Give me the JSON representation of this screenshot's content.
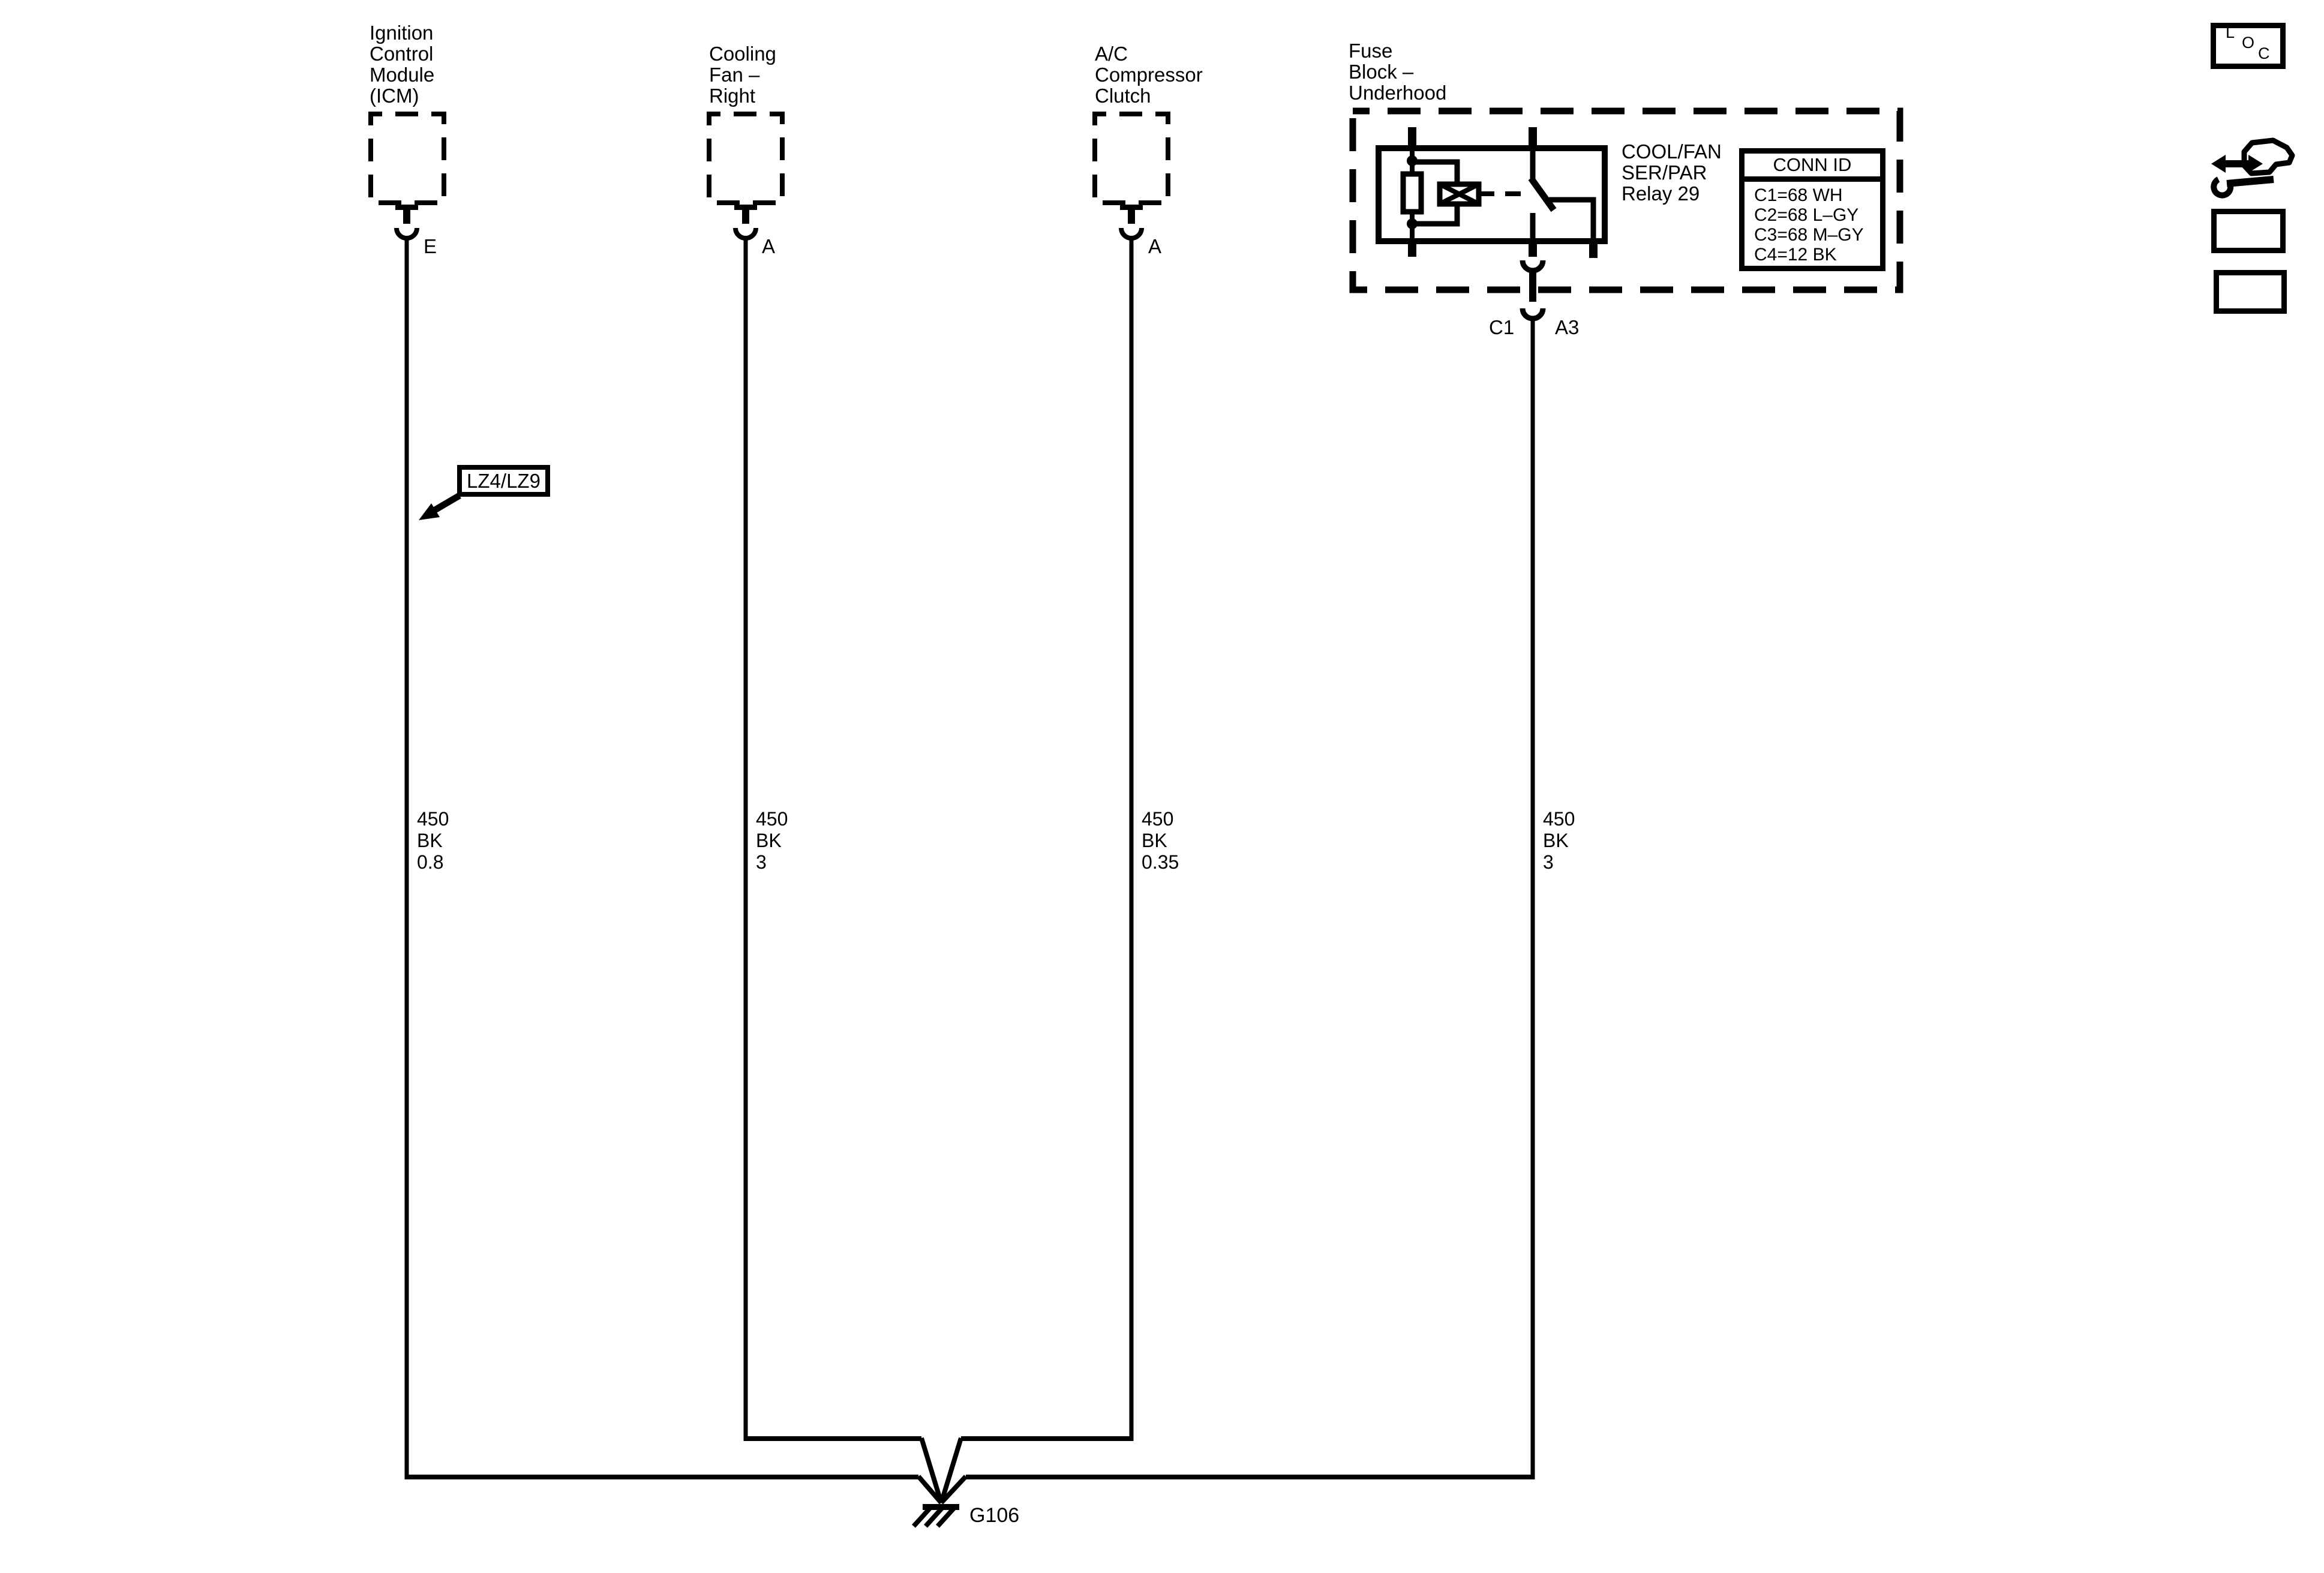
{
  "diagram": {
    "components": {
      "icm": {
        "name_lines": [
          "Ignition",
          "Control",
          "Module",
          "(ICM)"
        ],
        "pin": "E",
        "wire_label": [
          "450",
          "BK",
          "0.8"
        ]
      },
      "cooling_fan": {
        "name_lines": [
          "Cooling",
          "Fan –",
          "Right"
        ],
        "pin": "A",
        "wire_label": [
          "450",
          "BK",
          "3"
        ]
      },
      "ac_compressor": {
        "name_lines": [
          "A/C",
          "Compressor",
          "Clutch"
        ],
        "pin": "A",
        "wire_label": [
          "450",
          "BK",
          "0.35"
        ]
      },
      "fuse_block": {
        "name_lines": [
          "Fuse",
          "Block –",
          "Underhood"
        ],
        "relay_name_lines": [
          "COOL/FAN",
          "SER/PAR",
          "Relay 29"
        ],
        "conn_id": {
          "title": "CONN ID",
          "rows": [
            "C1=68 WH",
            "C2=68 L–GY",
            "C3=68 M–GY",
            "C4=12 BK"
          ]
        },
        "connector_pin_left": "C1",
        "connector_pin_right": "A3",
        "wire_label": [
          "450",
          "BK",
          "3"
        ]
      }
    },
    "engine_callout": "LZ4/LZ9",
    "ground_id": "G106"
  },
  "toolbar": {
    "loc_letters": [
      "L",
      "O",
      "C"
    ]
  },
  "colors": {
    "ink": "#000000",
    "paper": "#ffffff"
  }
}
